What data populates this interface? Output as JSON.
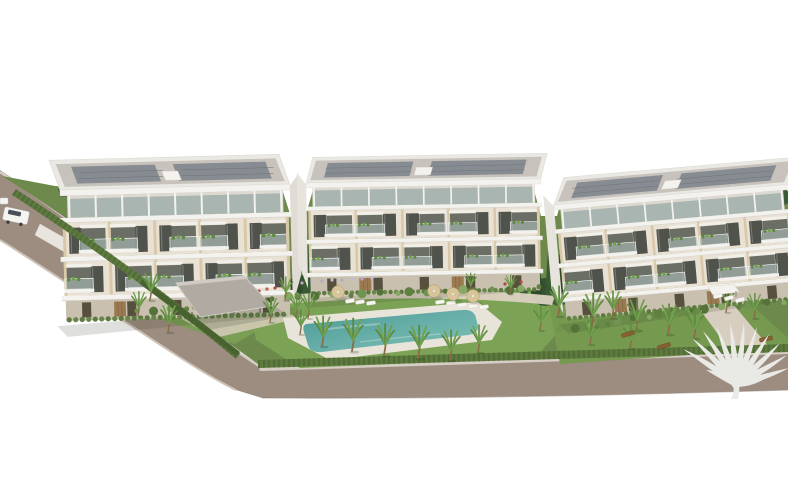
{
  "meta": {
    "description": "Aerial 3D architectural rendering of a residential complex: three modern white apartment buildings with balconies and rooftop solar panels, landscaped gardens with palm trees, a turquoise swimming pool with sun loungers and parasols, a covered carport, perimeter hedges and an access road, on a plain white background with a white palm-tree developer logo in the lower right corner.",
    "type": "architectural-aerial-render",
    "building_count": 3
  },
  "palette": {
    "sky": "#ffffff",
    "road": "#9c8d80",
    "roadCurbLight": "#d6cec4",
    "roadEdgeDark": "#8b7c6f",
    "wallLight": "#e9e5de",
    "terrain": "#6d8a4c",
    "lawn": "#7ca355",
    "lawnRight": "#74994f",
    "hedge": "#5d7a3e",
    "hedgeDark": "#47602f",
    "treeDark": "#32502c",
    "cypress": "#2e4a2b",
    "cypress2": "#3a5a34",
    "buildingWhite": "#f3f2ee",
    "buildingTrim": "#ddd9d1",
    "facadeWall": "#e9e2d4",
    "facadePier": "#d8c8a8",
    "windowDark": "#50534c",
    "openingDark": "#6a6e64",
    "balconyGlass": "rgba(178,197,194,0.55)",
    "roofSlab": "#eae8e3",
    "roofDeck": "#c7c2bb",
    "solar": "#878c92",
    "atticGlass": "#a8b5b1",
    "groundFloor": "#c9c0b0",
    "door": "#57503f",
    "wood": "#9b7a51",
    "poolDeck": "#e9e4da",
    "pool1": "#4e9a97",
    "pool2": "#7fc3b9",
    "path": "#dcd2c2",
    "carport": "#b0aaa2",
    "carportLight": "#cfcac3",
    "palmFrond": "#5e8a3f",
    "palmFrond2": "#72a04e",
    "palmTrunk": "#8a6b48",
    "umbrella": "#d8c49a",
    "lounger": "#f6f5f2",
    "bench": "#8a5f33",
    "flowerRed": "#b0483f",
    "flowerLavender": "#b7a6c9",
    "logo": "#e9eae6",
    "van": "#f4f4f2",
    "vanWindow": "#495057",
    "shadow": "rgba(55,65,45,0.16)"
  },
  "scene": {
    "buildings": [
      {
        "id": "apartment-building-1",
        "x": 62,
        "top": 196,
        "width": 226,
        "rotate": -1.5,
        "scale": 1,
        "backShift": -10,
        "side": "right",
        "bays": 5
      },
      {
        "id": "apartment-building-2",
        "x": 308,
        "top": 188,
        "width": 272,
        "rotate": -1,
        "scale": 0.85,
        "backShift": 8,
        "side": "left",
        "bays": 5
      },
      {
        "id": "apartment-building-3",
        "x": 556,
        "top": 210,
        "width": 264,
        "rotate": -5,
        "scale": 0.88,
        "backShift": 14,
        "side": "left",
        "bays": 5
      }
    ],
    "palms": [
      [
        322,
        346,
        1.1
      ],
      [
        352,
        351,
        1.2
      ],
      [
        384,
        355,
        1.15
      ],
      [
        418,
        358,
        1.2
      ],
      [
        450,
        360,
        1.1
      ],
      [
        478,
        352,
        1.0
      ],
      [
        300,
        334,
        0.9
      ],
      [
        270,
        322,
        0.9
      ],
      [
        308,
        318,
        0.9
      ],
      [
        150,
        300,
        1.0
      ],
      [
        138,
        316,
        0.9
      ],
      [
        168,
        332,
        1.0
      ],
      [
        285,
        300,
        0.85
      ],
      [
        296,
        316,
        0.8
      ],
      [
        558,
        316,
        1.1
      ],
      [
        592,
        326,
        1.2
      ],
      [
        612,
        318,
        1.0
      ],
      [
        636,
        330,
        1.15
      ],
      [
        668,
        334,
        1.1
      ],
      [
        694,
        338,
        1.05
      ],
      [
        590,
        344,
        0.9
      ],
      [
        630,
        348,
        0.9
      ],
      [
        540,
        330,
        0.9
      ],
      [
        726,
        312,
        0.9
      ],
      [
        754,
        318,
        0.9
      ],
      [
        470,
        292,
        0.7
      ],
      [
        510,
        294,
        0.7
      ]
    ],
    "umbrellas": [
      [
        338,
        292
      ],
      [
        434,
        291
      ],
      [
        453,
        294
      ],
      [
        473,
        296
      ]
    ],
    "loungers": [
      [
        350,
        301,
        -8
      ],
      [
        360,
        302,
        -8
      ],
      [
        371,
        303,
        -8
      ],
      [
        440,
        302,
        -8
      ],
      [
        451,
        303,
        -8
      ],
      [
        462,
        305,
        -8
      ],
      [
        473,
        306,
        -8
      ],
      [
        484,
        307,
        -8
      ],
      [
        718,
        296,
        -15
      ],
      [
        729,
        298,
        -15
      ],
      [
        740,
        300,
        -15
      ]
    ],
    "benches": [
      [
        628,
        334,
        -18
      ],
      [
        664,
        346,
        -18
      ],
      [
        766,
        339,
        -12
      ]
    ],
    "cypresses": [
      [
        296,
        213,
        298,
        11
      ],
      [
        307,
        228,
        300,
        9
      ],
      [
        537,
        220,
        300,
        11
      ],
      [
        549,
        236,
        303,
        9
      ],
      [
        560,
        248,
        300,
        8
      ],
      [
        524,
        238,
        298,
        8
      ]
    ],
    "treeClumps": [
      [
        300,
        287,
        12,
        "#35522f"
      ],
      [
        545,
        292,
        14,
        "#35522f"
      ],
      [
        559,
        296,
        10,
        "#41603a"
      ],
      [
        770,
        186,
        10,
        "#41603a"
      ],
      [
        781,
        197,
        9,
        "#3a5a34"
      ],
      [
        106,
        212,
        11,
        "#42643a"
      ],
      [
        118,
        203,
        15,
        "#4e7340"
      ],
      [
        129,
        213,
        10,
        "#5a8148"
      ]
    ],
    "bushRows": [
      {
        "from": [
          140,
          312
        ],
        "to": [
          300,
          296
        ],
        "n": 12
      },
      {
        "from": [
          300,
          296
        ],
        "to": [
          540,
          288
        ],
        "n": 16
      },
      {
        "from": [
          562,
          330
        ],
        "to": [
          690,
          310
        ],
        "n": 10
      },
      {
        "from": [
          690,
          310
        ],
        "to": [
          782,
          302
        ],
        "n": 7
      }
    ],
    "flowersLavender": [
      [
        302,
        283
      ],
      [
        312,
        282
      ],
      [
        322,
        281
      ],
      [
        332,
        280
      ],
      [
        342,
        280
      ],
      [
        352,
        279
      ],
      [
        362,
        279
      ],
      [
        372,
        278
      ]
    ],
    "flowersRed": [
      [
        243,
        294
      ],
      [
        251,
        292
      ],
      [
        259,
        291
      ],
      [
        267,
        289
      ],
      [
        275,
        288
      ],
      [
        283,
        287
      ],
      [
        505,
        284
      ],
      [
        513,
        283
      ],
      [
        521,
        282
      ]
    ],
    "logo": {
      "cx": 736,
      "cy": 384,
      "fronds": [
        [
          683,
          349
        ],
        [
          692,
          338
        ],
        [
          703,
          331
        ],
        [
          716,
          326
        ],
        [
          730,
          323
        ],
        [
          744,
          323
        ],
        [
          757,
          327
        ],
        [
          769,
          334
        ],
        [
          780,
          343
        ],
        [
          787,
          355
        ],
        [
          789,
          368
        ],
        [
          706,
          370
        ],
        [
          766,
          378
        ]
      ]
    }
  }
}
